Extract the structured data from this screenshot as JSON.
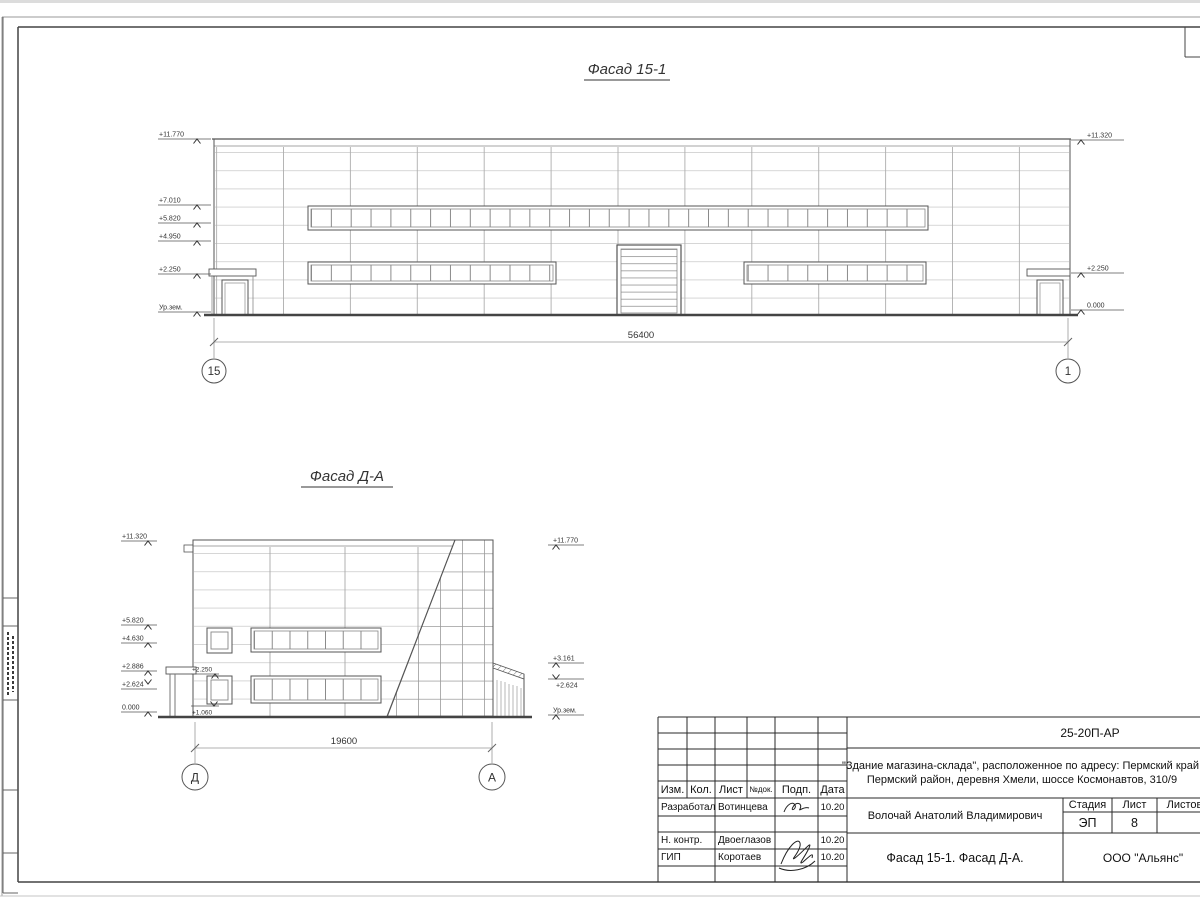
{
  "facade1": {
    "title": "Фасад 15-1",
    "marks_left": [
      "+11.770",
      "+7.010",
      "+5.820",
      "+4.950",
      "+2.250",
      "Ур.зем."
    ],
    "marks_right": [
      "+11.320",
      "+2.250",
      "0.000"
    ],
    "dim": "56400",
    "axis_left": "15",
    "axis_right": "1"
  },
  "facade2": {
    "title": "Фасад Д-А",
    "marks_left": [
      "+11.320",
      "+5.820",
      "+4.630",
      "+2.886",
      "+2.624",
      "0.000"
    ],
    "marks_right": [
      "+11.770",
      "+3.161",
      "+2.624",
      "Ур.зем."
    ],
    "marks_inner": [
      "+2.250",
      "+1.060"
    ],
    "dim": "19600",
    "axis_left": "Д",
    "axis_right": "А"
  },
  "titleblock": {
    "code": "25-20П-АР",
    "project_line1": "\"Здание магазина-склада\", расположенное по адресу: Пермский край,",
    "project_line2": "Пермский район, деревня Хмели, шоссе Космонавтов, 310/9",
    "rev_headers": [
      "Изм.",
      "Кол.",
      "Лист",
      "№док.",
      "Подп.",
      "Дата"
    ],
    "sign_rows": [
      {
        "role": "Разработал",
        "name": "Вотинцева",
        "date": "10.20"
      },
      {
        "role": "Н. контр.",
        "name": "Двоеглазов",
        "date": "10.20"
      },
      {
        "role": "ГИП",
        "name": "Коротаев",
        "date": "10.20"
      }
    ],
    "customer": "Волочай Анатолий Владимирович",
    "stage_header": "Стадия",
    "sheet_header": "Лист",
    "sheets_header": "Листов",
    "stage": "ЭП",
    "sheet_no": "8",
    "doc_title": "Фасад 15-1. Фасад Д-А.",
    "company": "ООО \"Альянс\""
  }
}
